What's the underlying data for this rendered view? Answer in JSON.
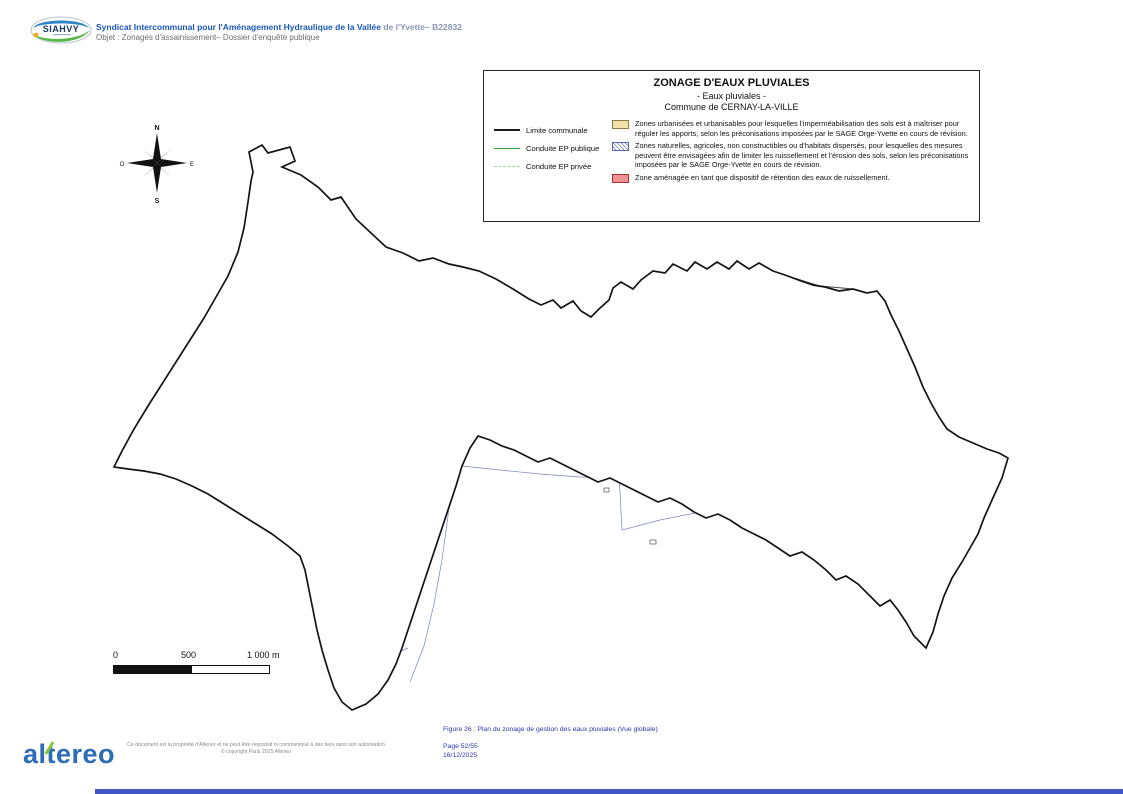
{
  "header": {
    "logo_text": "SIAHVY",
    "org_title_main": "Syndicat Intercommunal pour l'Aménagement Hydraulique de la Vallée ",
    "org_title_suffix": "de l'Yvette– B22832",
    "subject": "Objet : Zonages d'assainissement– Dossier d'enquête publique"
  },
  "legend": {
    "title": "ZONAGE D'EAUX PLUVIALES",
    "subtitle": "- Eaux pluviales -",
    "commune": "Commune de CERNAY-LA-VILLE",
    "line_items": [
      {
        "label": "Limite communale",
        "color": "#1c1c1c",
        "style": "solid"
      },
      {
        "label": "Conduite EP publique",
        "color": "#3aa43c",
        "style": "solid"
      },
      {
        "label": "Conduite EP privée",
        "color": "#9fd89f",
        "style": "dashed"
      }
    ],
    "zone_items": [
      {
        "swatch_color": "#f2e2a9",
        "text": "Zones urbanisées et urbanisables pour lesquelles l'imperméabilisation des sols est à maîtriser pour réguler les apports, selon les préconisations imposées par le SAGE Orge-Yvette en cours de révision."
      },
      {
        "swatch_color": "#6b77c4",
        "text": "Zones naturelles, agricoles, non constructibles ou d'habitats dispersés, pour lesquelles des mesures peuvent être envisagées afin de limiter les ruissellement et l'érosion des sols, selon les préconisations imposées par le SAGE Orge-Yvette en cours de révision."
      },
      {
        "swatch_color": "#ef9193",
        "text": "Zone aménagée en tant que dispositif de rétention des eaux de ruissellement."
      }
    ]
  },
  "map": {
    "compass": {
      "n": "N",
      "s": "S",
      "e": "E",
      "o": "O"
    },
    "scalebar": {
      "zero": "0",
      "mid": "500",
      "max": "1 000 m"
    }
  },
  "footer": {
    "logo_text": "altereo",
    "copyright_line1": "Ce document est la propriété d'Altereo et ne peut être reproduit ni communiqué à des tiers sans son autorisation",
    "copyright_line2": "© copyright Paris 2025 Altereo",
    "caption": "Figure 26 : Plan du zonage de gestion des eaux pluviales (Vue globale)",
    "page": "Page 52/55",
    "date": "16/12/2025"
  },
  "colors": {
    "header_blue": "#1a57c2",
    "hatch_blue": "#6b77c4",
    "urban_beige": "#f2e2a9",
    "retention_pink": "#ef9193",
    "conduit_green": "#2f9e3f",
    "lake_blue": "#c2e9f2",
    "footer_blue": "#2b36b0",
    "altereo_blue": "#2d6db5",
    "altereo_green": "#8dc63f"
  }
}
